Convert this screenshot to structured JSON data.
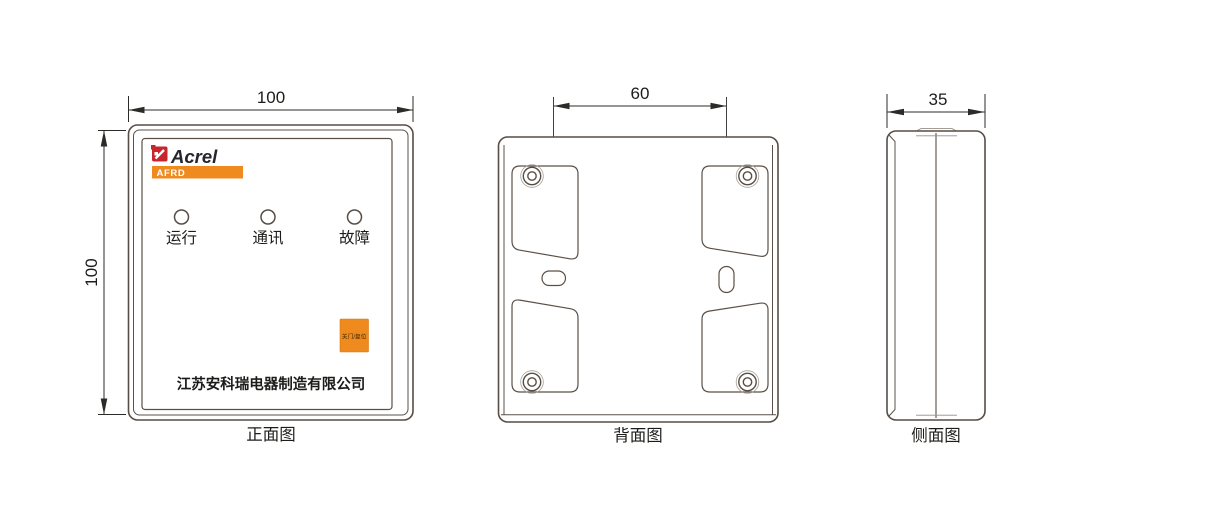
{
  "drawing": {
    "front": {
      "caption": "正面图",
      "width_dim": "100",
      "height_dim": "100",
      "brand": "Acrel",
      "model": "AFRD",
      "indicators": [
        {
          "label": "运行"
        },
        {
          "label": "通讯"
        },
        {
          "label": "故障"
        }
      ],
      "button_label": "关门/复位",
      "company": "江苏安科瑞电器制造有限公司"
    },
    "back": {
      "caption": "背面图",
      "hole_spacing_dim": "60"
    },
    "side": {
      "caption": "侧面图",
      "depth_dim": "35"
    }
  },
  "colors": {
    "accent_orange": "#ee8a1e",
    "brand_red": "#c9252c",
    "body_line": "#574d45",
    "dimension_line": "#2b2b28",
    "text": "#1c1c1a"
  }
}
